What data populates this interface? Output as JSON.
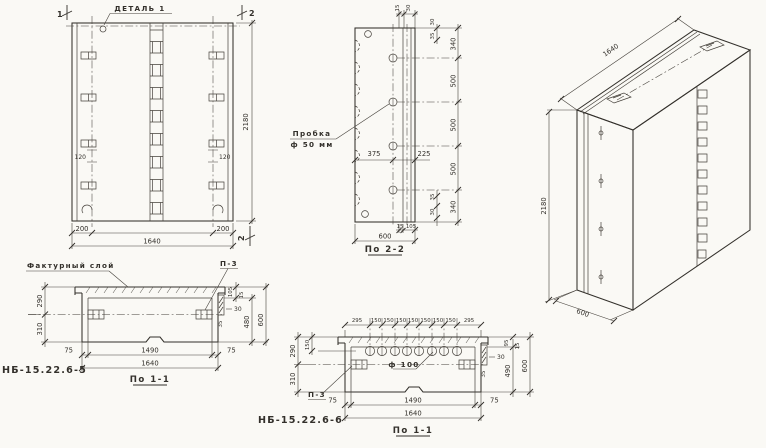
{
  "title_labels": {
    "detail": "ДЕТАЛЬ 1",
    "plug_line1": "Пробка",
    "plug_line2": "ф 50 мм",
    "facing_layer": "Фактурный слой",
    "p3_left": "П-3",
    "p3_mid": "П-3",
    "hole_dia": "ф 100",
    "mark_left": "НБ-15.22.6-5",
    "mark_mid": "НБ-15.22.6-6",
    "caption_plan_left": "По 1-1",
    "caption_plan_mid": "По 1-1",
    "caption_section": "По 2-2"
  },
  "front_view": {
    "flag_top_left": "1",
    "flag_top_right": "2",
    "flag_bottom_right": "2",
    "height": "2180",
    "width": "1640",
    "edge_left": "200",
    "edge_right": "200",
    "slot_left": "120",
    "slot_right": "120"
  },
  "section_2_2": {
    "top_small": [
      "15",
      "30"
    ],
    "right_inner_top": [
      "30",
      "35"
    ],
    "right_outer": [
      "340",
      "500",
      "500",
      "500",
      "340"
    ],
    "right_inner_bottom": [
      "35",
      "30"
    ],
    "hole_from_left": "375",
    "hole_from_right": "225",
    "bottom_small": [
      "15",
      "105"
    ],
    "width": "600"
  },
  "isometric": {
    "length": "1640",
    "height": "2180",
    "depth": "600"
  },
  "plan_left": {
    "left": [
      "290",
      "310"
    ],
    "right_small": [
      "105",
      "15",
      "30",
      "35"
    ],
    "cavity_depth": "480",
    "depth": "600",
    "bottom": [
      "75",
      "1490",
      "75"
    ],
    "width": "1640"
  },
  "plan_mid": {
    "top": [
      "295",
      "150",
      "150",
      "150",
      "150",
      "150",
      "150",
      "150",
      "295"
    ],
    "left_small": "150",
    "left": [
      "290",
      "310"
    ],
    "right_small": [
      "95",
      "15",
      "30",
      "35"
    ],
    "cavity_depth": "490",
    "depth": "600",
    "bottom": [
      "75",
      "1490",
      "75"
    ],
    "width": "1640"
  }
}
